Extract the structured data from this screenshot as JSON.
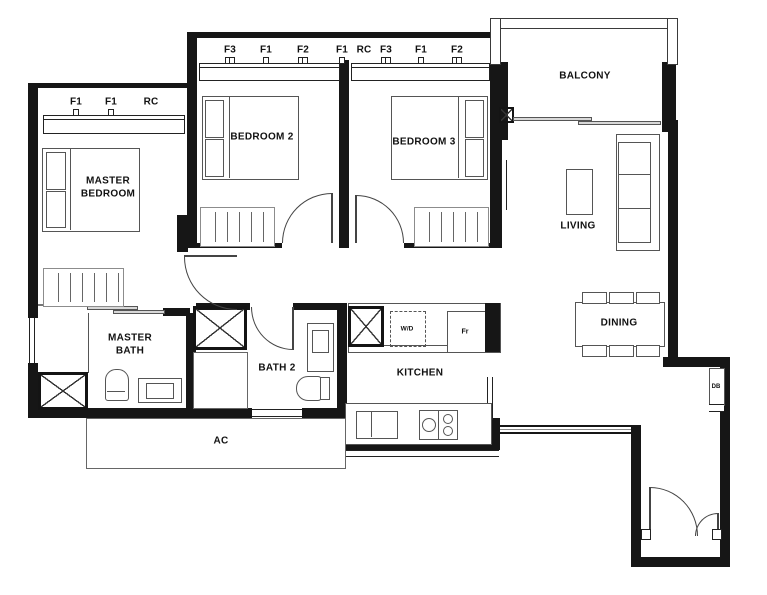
{
  "plan_type": "apartment-floor-plan",
  "colors": {
    "wall": "#161616",
    "furniture_line": "#555555",
    "text": "#111111",
    "background": "#ffffff"
  },
  "rooms": {
    "master_bedroom": {
      "line1": "MASTER",
      "line2": "BEDROOM"
    },
    "bedroom2": {
      "label": "BEDROOM 2"
    },
    "bedroom3": {
      "label": "BEDROOM 3"
    },
    "balcony": {
      "label": "BALCONY"
    },
    "living": {
      "label": "LIVING"
    },
    "dining": {
      "label": "DINING"
    },
    "kitchen": {
      "label": "KITCHEN"
    },
    "master_bath": {
      "line1": "MASTER",
      "line2": "BATH"
    },
    "bath2": {
      "label": "BATH 2"
    },
    "ac_ledge": {
      "label": "AC"
    }
  },
  "fixtures": {
    "washer_dryer": "W/D",
    "fridge": "Fr",
    "distribution_board": "DB"
  },
  "ceiling_markers": {
    "bedrooms_row": [
      "F3",
      "F1",
      "F2",
      "F1",
      "RC",
      "F3",
      "F1",
      "F2"
    ],
    "master_row": [
      "F1",
      "F1",
      "RC"
    ]
  }
}
